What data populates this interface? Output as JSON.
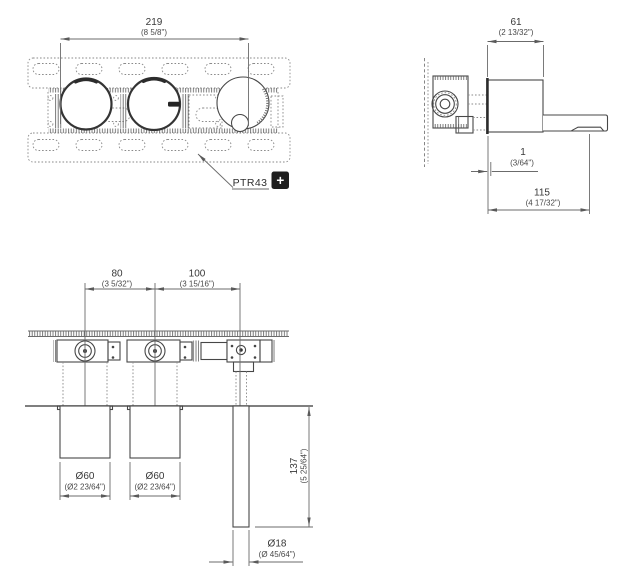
{
  "drawing": {
    "product_code": "PTR43",
    "plus_symbol": "+",
    "front": {
      "width": {
        "mm": "219",
        "inch": "(8 5/8\")"
      }
    },
    "side": {
      "body_width": {
        "mm": "61",
        "inch": "(2 13/32\")"
      },
      "wall_gap": {
        "mm": "1",
        "inch": "(3/64\")"
      },
      "spout_reach": {
        "mm": "115",
        "inch": "(4 17/32\")"
      }
    },
    "plan": {
      "handle_spacing": {
        "mm": "80",
        "inch": "(3 5/32\")"
      },
      "spout_offset": {
        "mm": "100",
        "inch": "(3 15/16\")"
      },
      "handle_diameter_left": {
        "mm": "Ø60",
        "inch": "(Ø2 23/64\")"
      },
      "handle_diameter_right": {
        "mm": "Ø60",
        "inch": "(Ø2 23/64\")"
      },
      "spout_drop": {
        "mm": "137",
        "inch": "(5 25/64\")"
      },
      "spout_diameter": {
        "mm": "Ø18",
        "inch": "(Ø 45/64\")"
      }
    },
    "colors": {
      "line": "#474747",
      "dimension": "#6b6b6b",
      "text": "#383838",
      "badge_bg": "#1f1f1f",
      "badge_fg": "#ffffff"
    }
  }
}
